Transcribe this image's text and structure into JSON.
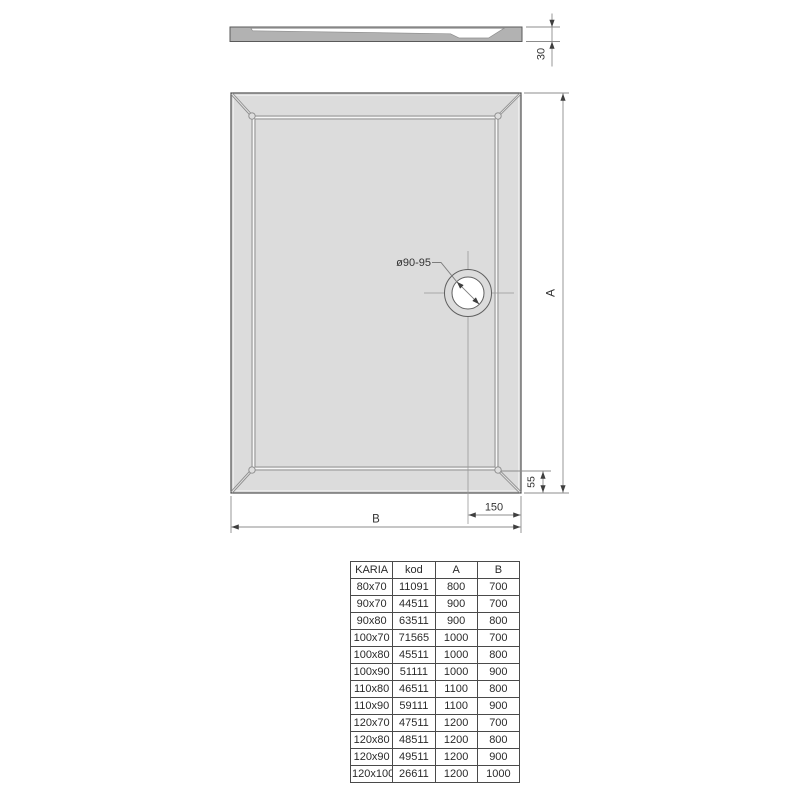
{
  "drawing": {
    "section_view": {
      "height_dim": "30"
    },
    "plan_view": {
      "drain_diameter_dim": "ø90-95",
      "length_dim": "A",
      "width_dim": "B",
      "drain_offset_dim": "150",
      "rim_offset_dim": "55"
    },
    "colors": {
      "plan_fill": "#dcdcdc",
      "section_fill": "#b2b2b2",
      "outline": "#4f4f4f",
      "dimension_line": "#8c8c8c",
      "arrow": "#3f3f3f",
      "text": "#333333"
    }
  },
  "table": {
    "columns": [
      "KARIA",
      "kod",
      "A",
      "B"
    ],
    "rows": [
      [
        "80x70",
        "11091",
        "800",
        "700"
      ],
      [
        "90x70",
        "44511",
        "900",
        "700"
      ],
      [
        "90x80",
        "63511",
        "900",
        "800"
      ],
      [
        "100x70",
        "71565",
        "1000",
        "700"
      ],
      [
        "100x80",
        "45511",
        "1000",
        "800"
      ],
      [
        "100x90",
        "51111",
        "1000",
        "900"
      ],
      [
        "110x80",
        "46511",
        "1100",
        "800"
      ],
      [
        "110x90",
        "59111",
        "1100",
        "900"
      ],
      [
        "120x70",
        "47511",
        "1200",
        "700"
      ],
      [
        "120x80",
        "48511",
        "1200",
        "800"
      ],
      [
        "120x90",
        "49511",
        "1200",
        "900"
      ],
      [
        "120x100",
        "26611",
        "1200",
        "1000"
      ]
    ]
  }
}
